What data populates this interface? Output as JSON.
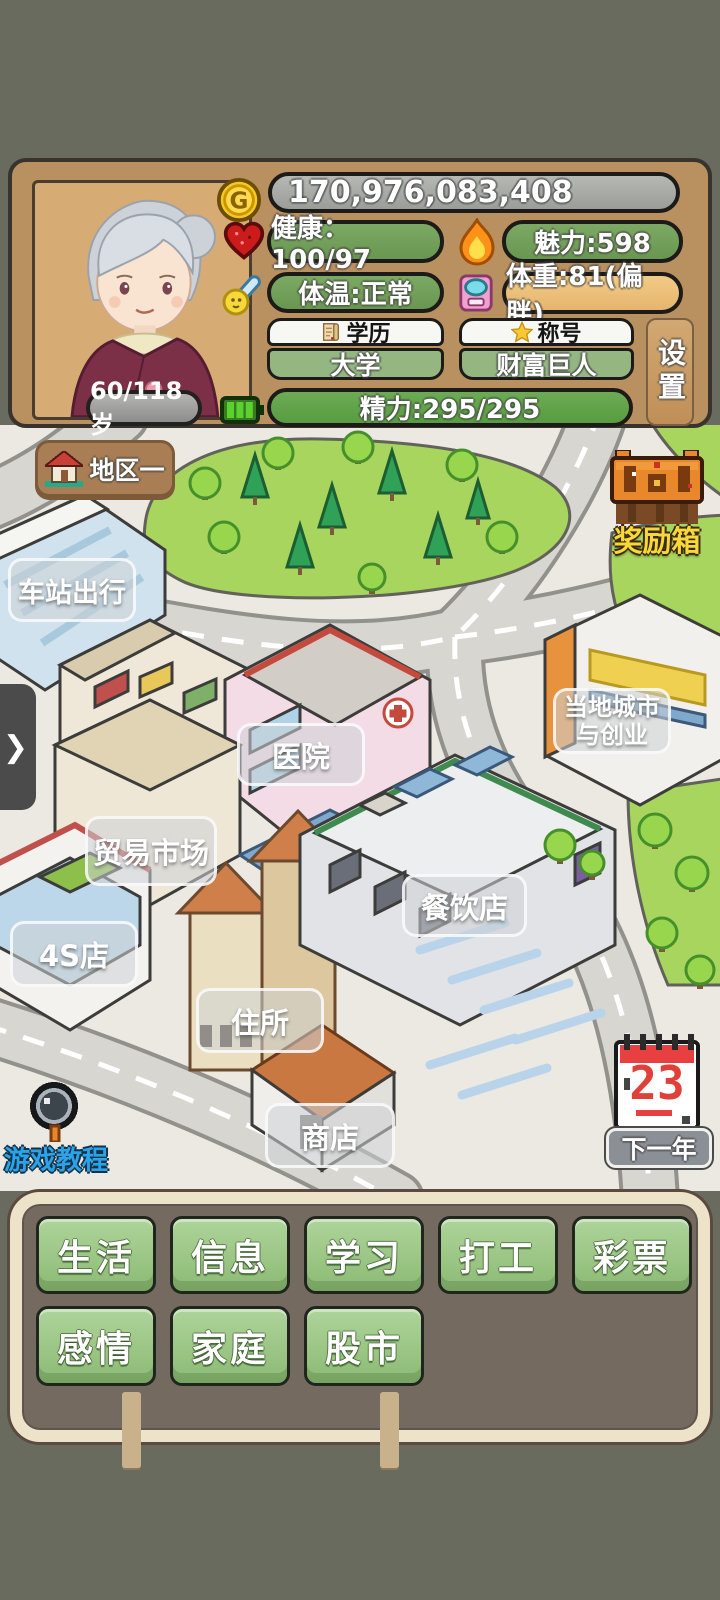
{
  "header": {
    "money": "170,976,083,408",
    "age": "60/118岁",
    "health": "健康：100/97",
    "charm": "魅力:598",
    "temperature": "体温:正常",
    "weight": "体重:81(偏胖)",
    "education_label": "学历",
    "education_value": "大学",
    "title_label": "称号",
    "title_value": "财富巨人",
    "energy": "精力:295/295",
    "settings": "设置"
  },
  "map": {
    "region": "地区一",
    "reward_box": "奖励箱",
    "tutorial": "游戏教程",
    "calendar_day": "23",
    "next_year": "下一年",
    "chevron": "❯",
    "locations": [
      "车站出行",
      "医院",
      "贸易市场",
      "4S店",
      "住所",
      "商店",
      "餐饮店"
    ],
    "city_venture": {
      "line1": "当地城市",
      "line2": "与创业"
    }
  },
  "actions": {
    "row1": [
      "生活",
      "信息",
      "学习",
      "打工",
      "彩票"
    ],
    "row2": [
      "感情",
      "家庭",
      "股市"
    ]
  },
  "colors": {
    "page_bg": "#696b5f",
    "panel_bg": "#b9905f",
    "pill_green": "#6f9d55",
    "weight_orange": "#eec07c",
    "money_grey": "#a7a9a5",
    "action_green": "#9ac77f",
    "sign_border": "#ece3c9",
    "reward_text": "#f8d838",
    "tutorial_text": "#2ba3e8"
  }
}
